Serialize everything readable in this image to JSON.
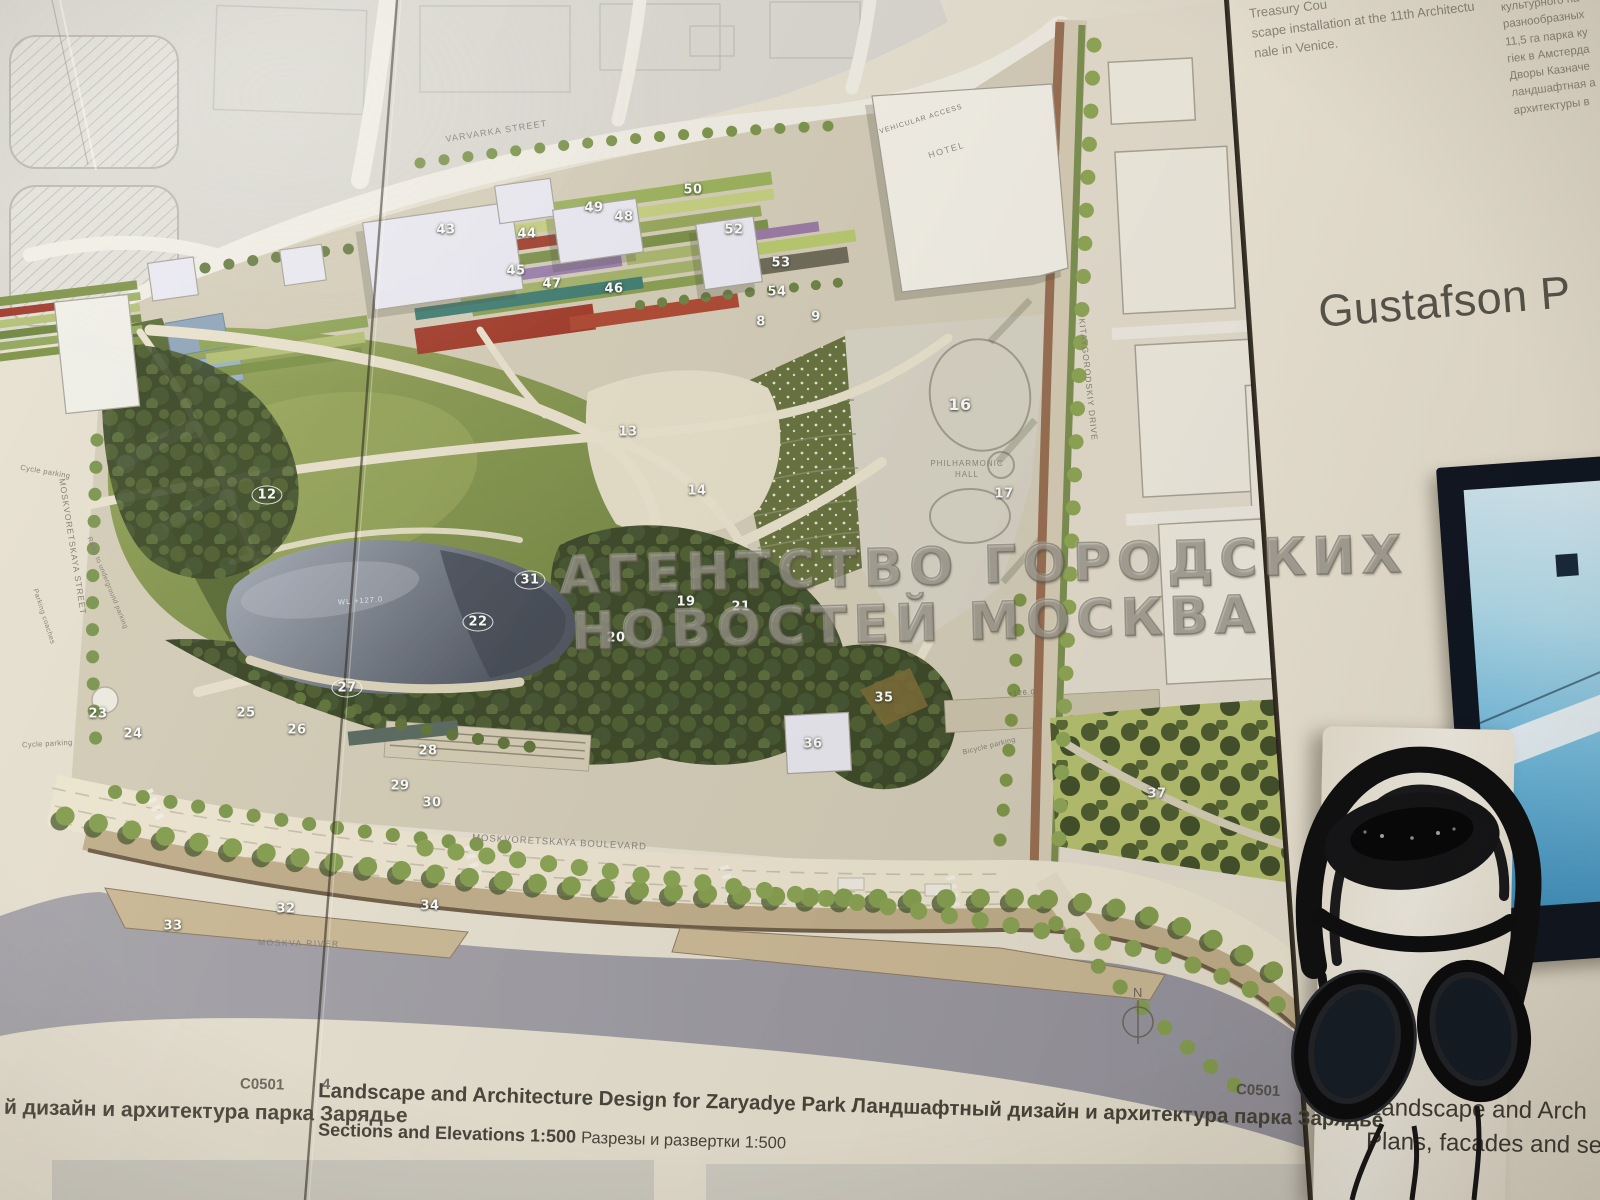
{
  "plan": {
    "labels": {
      "varvarka_street": "VARVARKA STREET",
      "moskvoretskaya_street": "MOSKVORETSKAYA STREET",
      "moskvoretskaya_boulevard": "MOSKVORETSKAYA BOULEVARD",
      "kitaygorodskiy_drive": "KITAYGORODSKIY DRIVE",
      "moskva_river": "MOSKVA RIVER",
      "hotel": "HOTEL",
      "philharmonic_line1": "PHILHARMONIC",
      "philharmonic_line2": "HALL",
      "vehicular_access": "VEHICULAR ACCESS",
      "cycle_parking_top": "Cycle parking",
      "cycle_parking_bottom": "Cycle parking",
      "parking_coaches": "Parking coaches",
      "ramp_underground": "Ramp to underground parking",
      "bicycle_parking": "Bicycle parking",
      "water_level": "WL +127.0",
      "elevation_126": "+126.0",
      "north": "N"
    },
    "markers": [
      "8",
      "9",
      "12",
      "13",
      "14",
      "16",
      "17",
      "19",
      "20",
      "21",
      "22",
      "23",
      "24",
      "25",
      "26",
      "27",
      "28",
      "29",
      "30",
      "31",
      "32",
      "33",
      "34",
      "35",
      "36",
      "37",
      "43",
      "44",
      "45",
      "46",
      "47",
      "48",
      "49",
      "50",
      "52",
      "53",
      "54"
    ],
    "captions": {
      "sheet_code_left": "C0501",
      "page_number": "4",
      "left_ru": "й дизайн и архитектура парка Зарядье",
      "title_en": "Landscape and Architecture Design for Zaryadye Park",
      "title_ru": "Ландшафтный дизайн и архитектура парка Зарядье",
      "subtitle_en": "Sections and Elevations 1:500",
      "subtitle_ru": "Разрезы и развертки 1:500",
      "sheet_code_right": "C0501"
    }
  },
  "watermark": {
    "line1": "АГЕНТСТВО ГОРОДСКИХ",
    "line2": "НОВОСТЕЙ МОСКВА"
  },
  "right_board": {
    "intro_en": [
      "Treasury Cou",
      "scape installation at the 11th Architectu",
      "nale in Venice."
    ],
    "intro_ru": [
      "культурного на",
      "разнообразных",
      "11,5 га парка ку",
      "гiек в Амстерда",
      "Дворы Казначе",
      "ландшафтная а",
      "архитектуры в"
    ],
    "title": "Gustafson P",
    "caption_line1": "Landscape and Arch",
    "caption_line2": "Plans, facades and se"
  },
  "colors": {
    "paper": "#e9e3d3",
    "right_board": "#f0e9da",
    "lawn": "#8a9c52",
    "forest": "#3d4b27",
    "pond": "#545b66",
    "river": "#a3a1a8",
    "screen_blue": "#5fb3dc",
    "headphones": "#0e0e10"
  }
}
